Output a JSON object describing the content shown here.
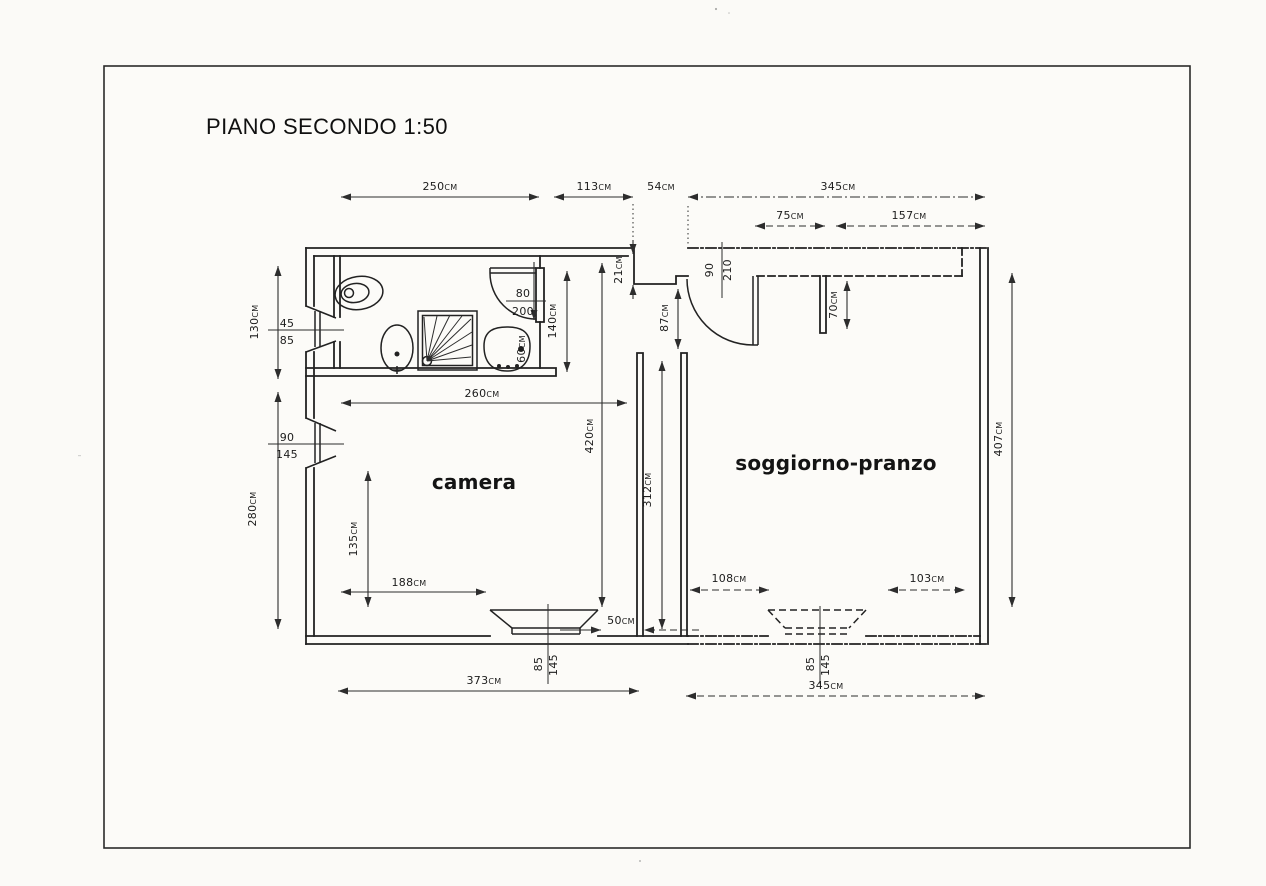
{
  "sheet": {
    "title": "PIANO SECONDO 1:50"
  },
  "rooms": {
    "camera": "camera",
    "soggiorno_pranzo": "soggiorno-pranzo"
  },
  "dimensions": {
    "top": {
      "d250": "250cm",
      "d113": "113cm",
      "d54": "54cm",
      "d345": "345cm",
      "d75": "75cm",
      "d157": "157cm"
    },
    "left": {
      "d130": "130cm",
      "d280": "280cm"
    },
    "right": {
      "d407": "407cm"
    },
    "bottom": {
      "d373": "373cm",
      "d345": "345cm",
      "d50": "50cm",
      "d188": "188cm",
      "d108": "108cm",
      "d103": "103cm",
      "d135": "135cm"
    },
    "interior": {
      "d260": "260cm",
      "d420": "420cm",
      "d140": "140cm",
      "d60": "60cm",
      "d21": "21cm",
      "d87": "87cm",
      "d70": "70cm",
      "d312": "312cm"
    }
  },
  "openings": {
    "bath_window": {
      "width": "45",
      "height": "85"
    },
    "camera_window": {
      "width": "90",
      "height": "145"
    },
    "bath_door": {
      "width": "80",
      "height": "200"
    },
    "entry_door": {
      "width": "90",
      "height": "210"
    },
    "camera_south_window": {
      "width": "85",
      "height": "145"
    },
    "soggiorno_south_window": {
      "width": "85",
      "height": "145"
    }
  },
  "colors": {
    "ink": "#222222",
    "paper": "#fcfbf8"
  }
}
